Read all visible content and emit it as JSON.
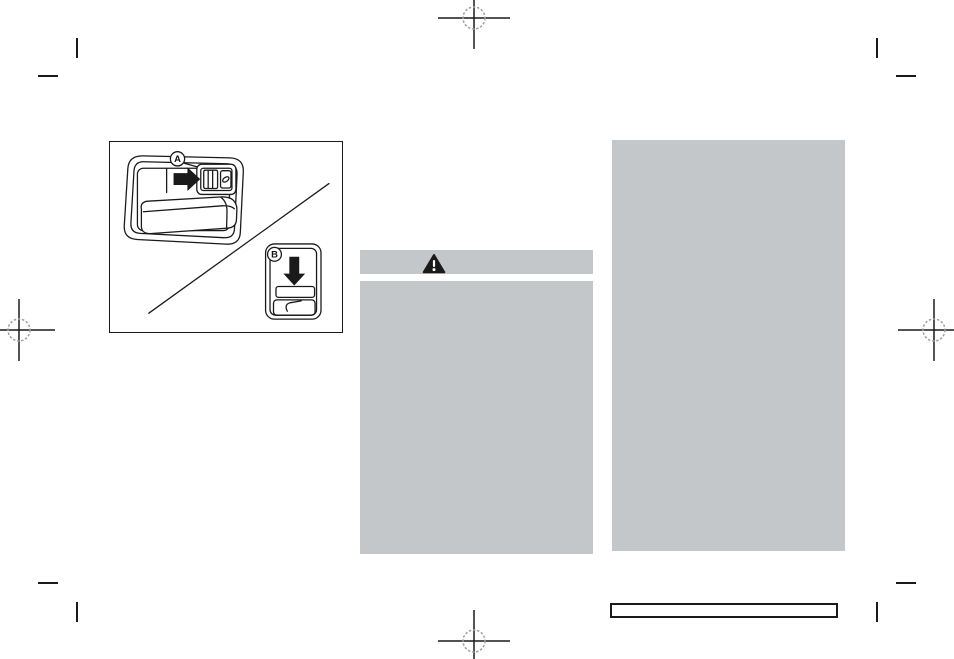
{
  "page": {
    "background_color": "#ffffff",
    "ink_color": "#1a1a1a",
    "redaction_color": "#c3c7ca"
  },
  "figure": {
    "callout_a": "A",
    "callout_b": "B",
    "icons": [
      "right-arrow-icon",
      "down-arrow-icon",
      "power-window-switch-icon",
      "window-tilt-icon"
    ]
  },
  "warning": {
    "icon": "warning-triangle-icon",
    "icon_color": "#1a1a1a",
    "header_background": "#c3c7ca"
  }
}
